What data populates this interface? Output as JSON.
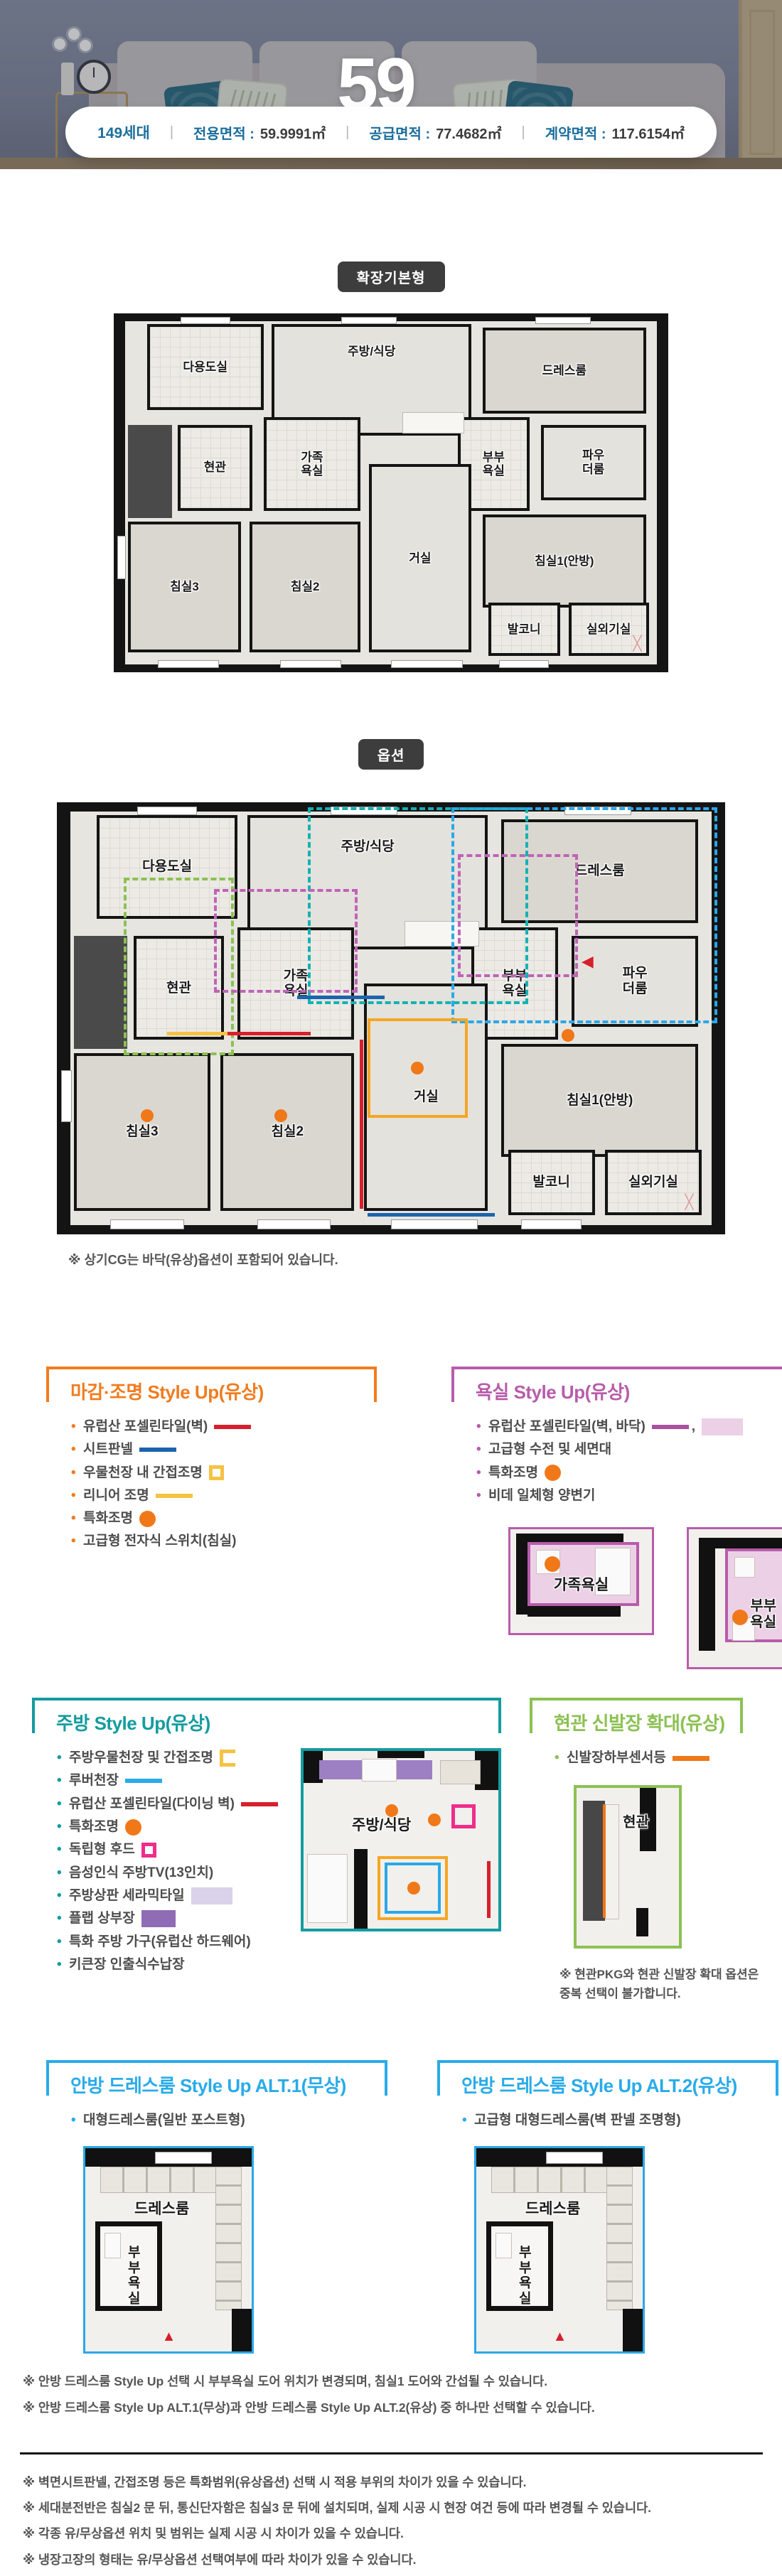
{
  "hero": {
    "number": "59",
    "unit": "㎡"
  },
  "summary": {
    "households": "149세대",
    "divider": "|",
    "items": [
      {
        "label": "전용면적 :",
        "value": "59.9991㎡"
      },
      {
        "label": "공급면적 :",
        "value": "77.4682㎡"
      },
      {
        "label": "계약면적 :",
        "value": "117.6154㎡"
      }
    ]
  },
  "badges": {
    "base": "확장기본형",
    "option": "옵션"
  },
  "rooms": {
    "utility": "다용도실",
    "kitchen": "주방/식당",
    "dress": "드레스룸",
    "entrance": "현관",
    "fambath": "가족\n욕실",
    "cpbath": "부부\n욕실",
    "powder": "파우\n더룸",
    "bed1": "침실1(안방)",
    "bed2": "침실2",
    "bed3": "침실3",
    "living": "거실",
    "balcony": "발코니",
    "outdoor": "실외기실",
    "fambath_one_line": "가족욕실",
    "cpbath_one_line": "부부욕실"
  },
  "plan_option_note": "※ 상기CG는 바닥(유상)옵션이 포함되어 있습니다.",
  "accents": {
    "orange": "#f07c1f",
    "magenta": "#b85cab",
    "teal": "#149c9f",
    "green": "#8cc152",
    "blue": "#29abe9"
  },
  "sections": {
    "finish": {
      "title": "마감·조명 Style Up(유상)",
      "items": [
        {
          "text": "유럽산 포셀린타일(벽)"
        },
        {
          "text": "시트판넬"
        },
        {
          "text": "우물천장 내 간접조명"
        },
        {
          "text": "리니어 조명"
        },
        {
          "text": "특화조명"
        },
        {
          "text": "고급형 전자식 스위치(침실)"
        }
      ]
    },
    "bath": {
      "title": "욕실 Style Up(유상)",
      "items": [
        {
          "text": "유럽산 포셀린타일(벽, 바닥)"
        },
        {
          "text": "고급형 수전 및 세면대"
        },
        {
          "text": "특화조명"
        },
        {
          "text": "비데 일체형 양변기"
        }
      ]
    },
    "kitchen": {
      "title": "주방 Style Up(유상)",
      "items": [
        {
          "text": "주방우물천장 및 간접조명"
        },
        {
          "text": "루버천장"
        },
        {
          "text": "유럽산 포셀린타일(다이닝 벽)"
        },
        {
          "text": "특화조명"
        },
        {
          "text": "독립형 후드"
        },
        {
          "text": "음성인식 주방TV(13인치)"
        },
        {
          "text": "주방상판 세라믹타일"
        },
        {
          "text": "플랩 상부장"
        },
        {
          "text": "특화 주방 가구(유럽산 하드웨어)"
        },
        {
          "text": "키큰장 인출식수납장"
        }
      ]
    },
    "entrance": {
      "title": "현관 신발장 확대(유상)",
      "items": [
        {
          "text": "신발장하부센서등"
        }
      ],
      "note": "※ 현관PKG와 현관 신발장 확대 옵션은 중복 선택이 불가합니다."
    },
    "dress1": {
      "title": "안방 드레스룸 Style Up ALT.1(무상)",
      "items": [
        {
          "text": "대형드레스룸(일반 포스트형)"
        }
      ]
    },
    "dress2": {
      "title": "안방 드레스룸 Style Up ALT.2(유상)",
      "items": [
        {
          "text": "고급형 대형드레스룸(벽 판넬 조명형)"
        }
      ]
    }
  },
  "dress_notes": [
    "※ 안방 드레스룸 Style Up 선택 시 부부욕실 도어 위치가 변경되며, 침실1 도어와 간섭될 수 있습니다.",
    "※ 안방 드레스룸 Style Up ALT.1(무상)과 안방 드레스룸 Style Up ALT.2(유상) 중 하나만 선택할 수 있습니다."
  ],
  "footer_notes": [
    "※ 벽면시트판넬, 간접조명 등은 특화범위(유상옵션) 선택 시 적용 부위의 차이가 있을 수 있습니다.",
    "※ 세대분전반은 침실2 문 뒤, 통신단자함은 침실3 문 뒤에 설치되며, 실제 시공 시 현장 여건 등에 따라 변경될 수 있습니다.",
    "※ 각종 유/무상옵션 위치 및 범위는 실제 시공 시 차이가 있을 수 있습니다.",
    "※ 냉장고장의 형태는 유/무상옵션 선택여부에 따라 차이가 있을 수 있습니다."
  ]
}
